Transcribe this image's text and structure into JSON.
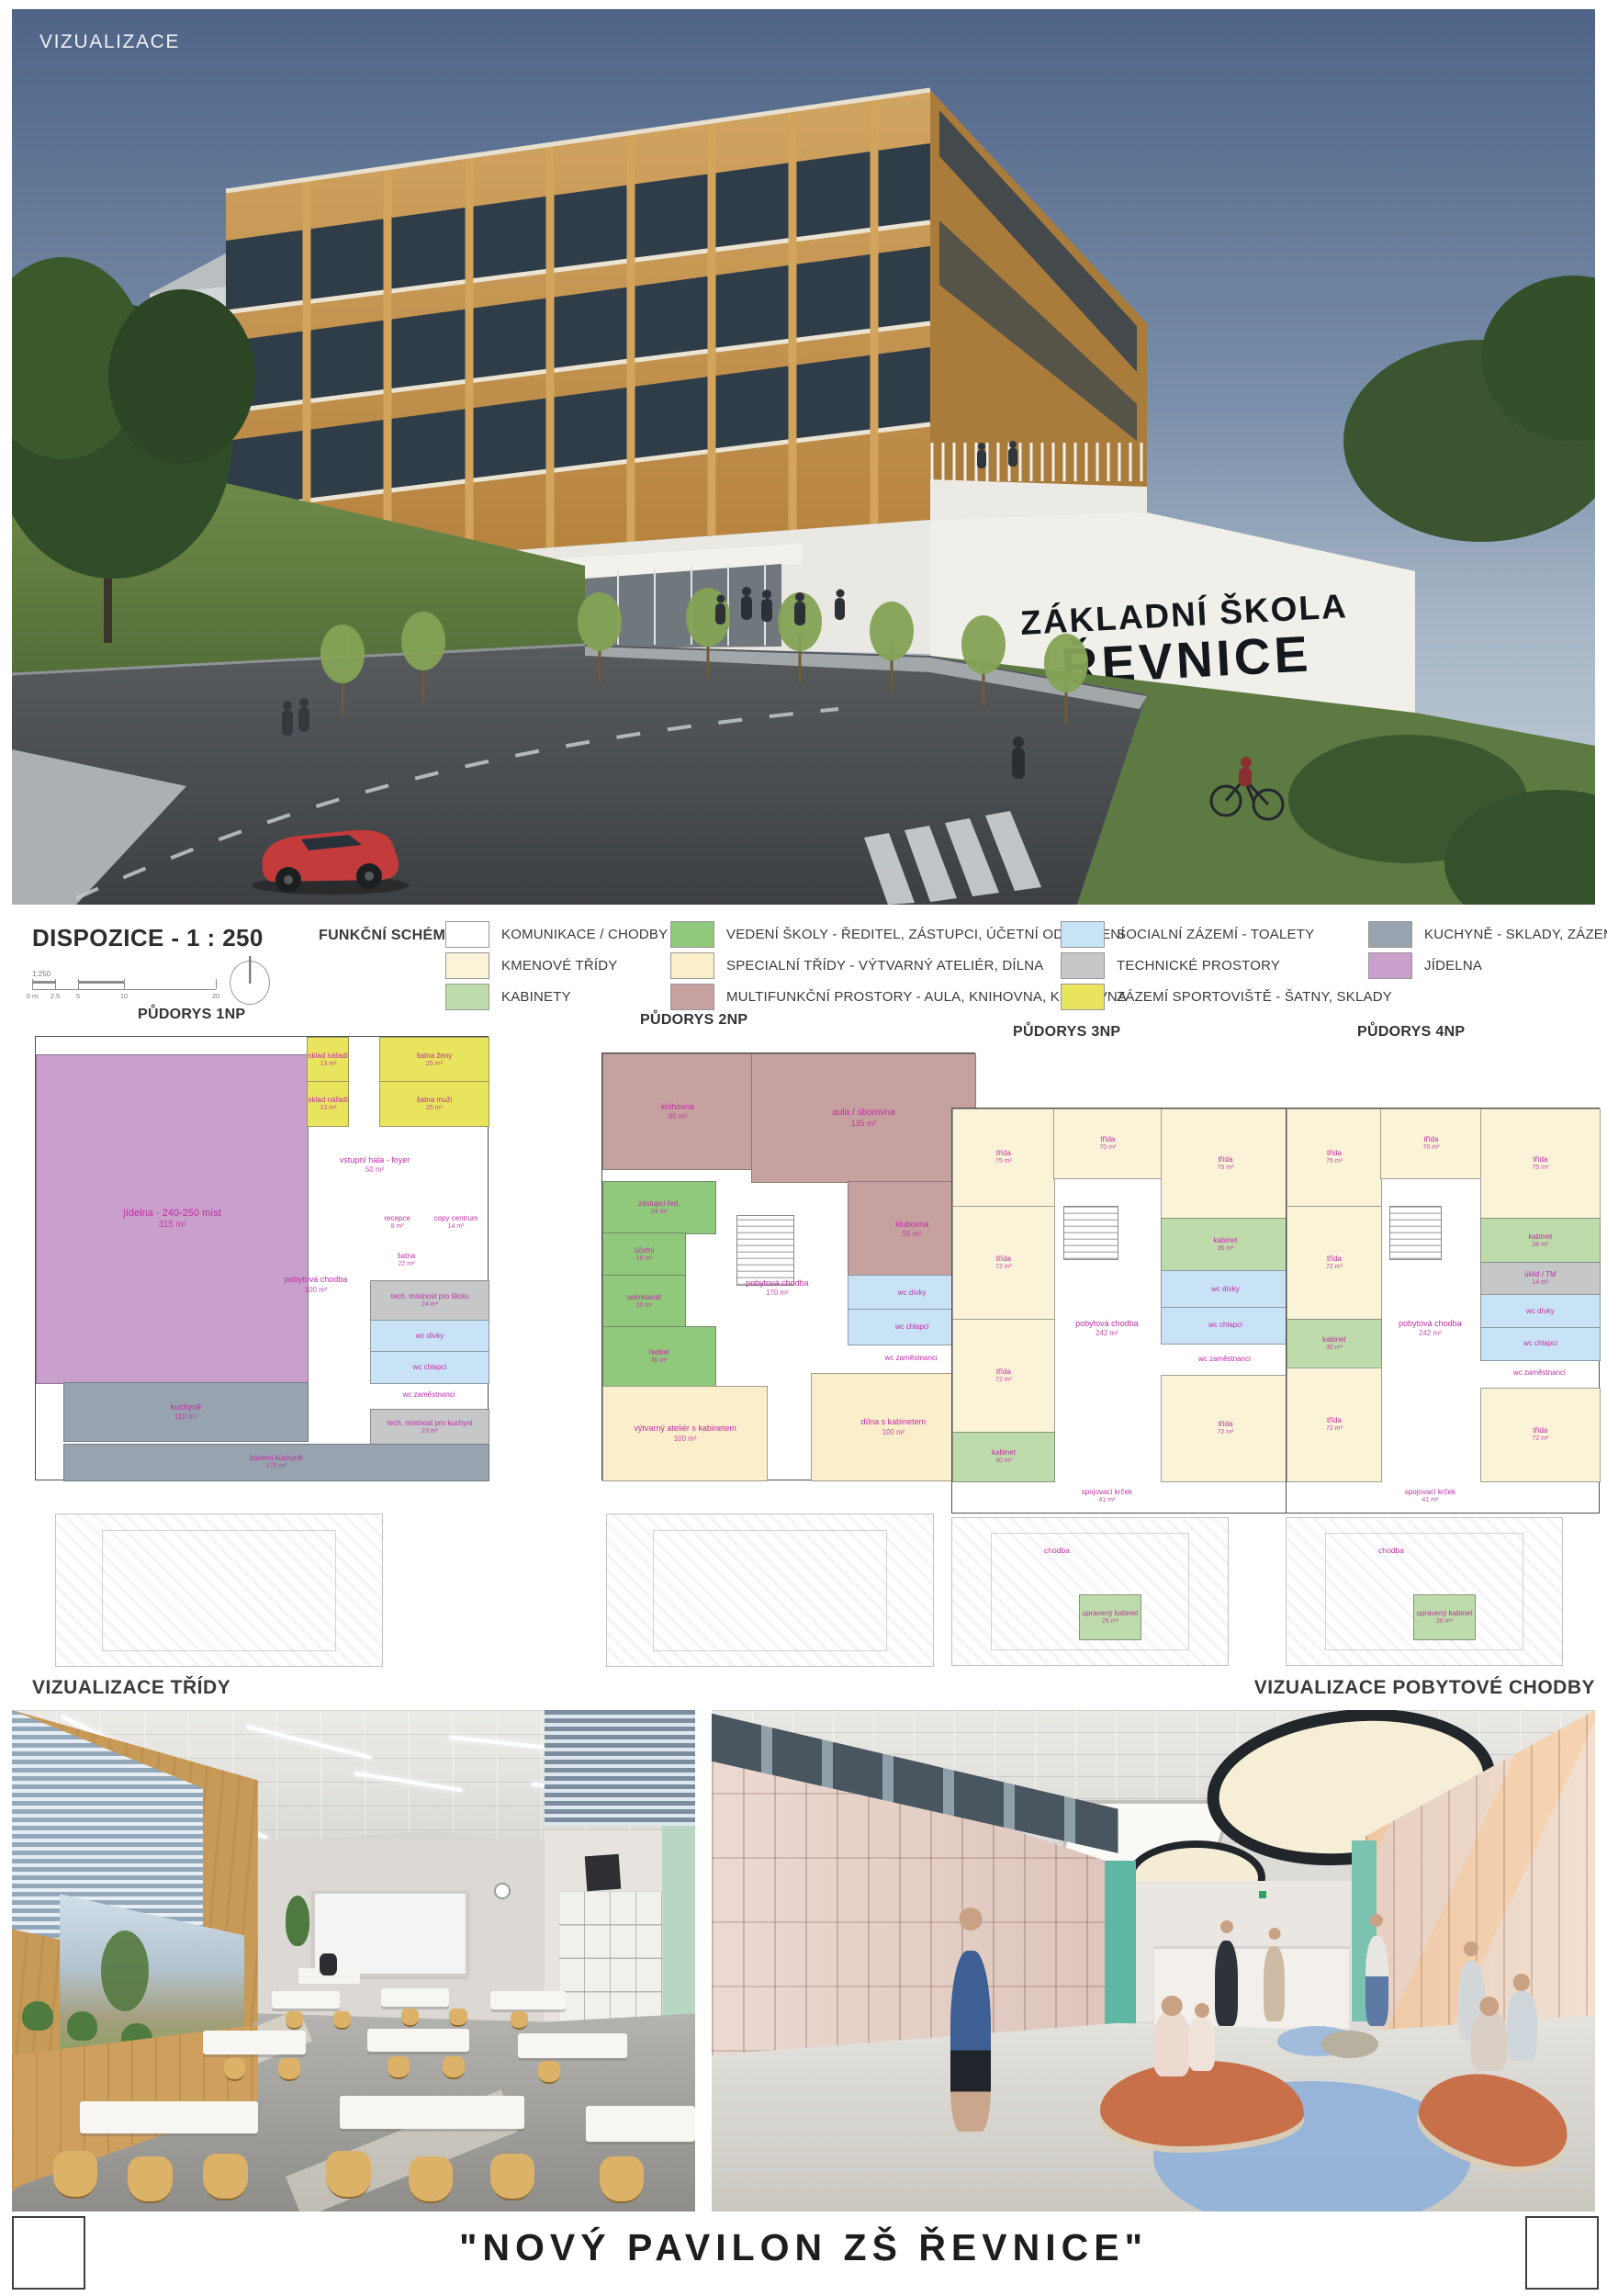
{
  "hero": {
    "label": "VIZUALIZACE",
    "sign_line1": "ZÁKLADNÍ ŠKOLA",
    "sign_line2": "ŘEVNICE"
  },
  "dispozice": {
    "title": "DISPOZICE - 1 : 250",
    "schema_label": "FUNKČNÍ SCHÉMA",
    "scale": {
      "ratio": "1:250",
      "ticks": [
        {
          "t": "0 m",
          "p": 0
        },
        {
          "t": "2.5",
          "p": 12.5
        },
        {
          "t": "5",
          "p": 25
        },
        {
          "t": "10",
          "p": 50
        },
        {
          "t": "20",
          "p": 100
        }
      ]
    },
    "legend_columns": [
      {
        "items": [
          {
            "color": "#ffffff",
            "label": "KOMUNIKACE / CHODBY"
          },
          {
            "color": "#faf3d8",
            "label": "KMENOVÉ TŘÍDY"
          },
          {
            "color": "#bedcab",
            "label": "KABINETY"
          }
        ]
      },
      {
        "items": [
          {
            "color": "#90c87c",
            "label": "VEDENÍ ŠKOLY - ŘEDITEL, ZÁSTUPCI, ÚČETNÍ ODDDĚLENÍ"
          },
          {
            "color": "#fbeecb",
            "label": "SPECIALNÍ TŘÍDY - VÝTVARNÝ ATELIÉR, DÍLNA"
          },
          {
            "color": "#c7a0a0",
            "label": "MULTIFUNKČNÍ PROSTORY - AULA, KNIHOVNA, KLUBOVNA"
          }
        ]
      },
      {
        "items": [
          {
            "color": "#c9e3f6",
            "label": "SOCIALNÍ ZÁZEMÍ - TOALETY"
          },
          {
            "color": "#c5c7c9",
            "label": "TECHNICKÉ PROSTORY"
          },
          {
            "color": "#e9e45e",
            "label": "ZÁZEMÍ SPORTOVIŠTĚ - ŠATNY, SKLADY"
          }
        ]
      },
      {
        "items": [
          {
            "color": "#97a3af",
            "label": "KUCHYNĚ - SKLADY, ZÁZEMÍ"
          },
          {
            "color": "#c99fcb",
            "label": "JÍDELNA"
          }
        ]
      }
    ]
  },
  "plans": [
    {
      "title": "PŮDORYS 1NP",
      "rooms": [
        {
          "x": 0,
          "y": 4,
          "w": 60,
          "h": 74,
          "c": "#c99fcb",
          "label": "jídelna - 240-250 míst",
          "area": "315 m²",
          "fs": 11
        },
        {
          "x": 60,
          "y": 0,
          "w": 9,
          "h": 10,
          "c": "#e9e45e",
          "label": "sklad nářadí",
          "area": "13 m²"
        },
        {
          "x": 60,
          "y": 10,
          "w": 9,
          "h": 10,
          "c": "#e9e45e",
          "label": "sklad nářadí",
          "area": "13 m²"
        },
        {
          "x": 76,
          "y": 0,
          "w": 24,
          "h": 10,
          "c": "#e9e45e",
          "label": "šatna ženy",
          "area": "25 m²"
        },
        {
          "x": 76,
          "y": 10,
          "w": 24,
          "h": 10,
          "c": "#e9e45e",
          "label": "šatna muži",
          "area": "25 m²"
        },
        {
          "x": 62,
          "y": 22,
          "w": 26,
          "h": 14,
          "c": "none",
          "label": "vstupní hala - foyer",
          "area": "50 m²",
          "fs": 9
        },
        {
          "x": 52,
          "y": 40,
          "w": 20,
          "h": 32,
          "c": "none",
          "label": "pobytová chodba",
          "area": "100 m²",
          "fs": 9
        },
        {
          "x": 74,
          "y": 38,
          "w": 12,
          "h": 8,
          "c": "none",
          "label": "recepce",
          "area": "8 m²"
        },
        {
          "x": 86,
          "y": 38,
          "w": 14,
          "h": 8,
          "c": "none",
          "label": "copy centrum",
          "area": "14 m²"
        },
        {
          "x": 74,
          "y": 46,
          "w": 16,
          "h": 9,
          "c": "none",
          "label": "šatna",
          "area": "22 m²"
        },
        {
          "x": 74,
          "y": 55,
          "w": 26,
          "h": 9,
          "c": "#c5c7c9",
          "label": "tech. místnost pro školu",
          "area": "24 m²"
        },
        {
          "x": 74,
          "y": 64,
          "w": 26,
          "h": 7,
          "c": "#c9e3f6",
          "label": "wc dívky",
          "area": ""
        },
        {
          "x": 74,
          "y": 71,
          "w": 26,
          "h": 7,
          "c": "#c9e3f6",
          "label": "wc chlapci",
          "area": ""
        },
        {
          "x": 74,
          "y": 78,
          "w": 26,
          "h": 6,
          "c": "none",
          "label": "wc zaměstnanci",
          "area": ""
        },
        {
          "x": 6,
          "y": 78,
          "w": 54,
          "h": 13,
          "c": "#97a3af",
          "label": "kuchyně",
          "area": "110 m²",
          "fs": 9
        },
        {
          "x": 74,
          "y": 84,
          "w": 26,
          "h": 8,
          "c": "#c5c7c9",
          "label": "tech. místnost pro kuchyni",
          "area": "23 m²"
        },
        {
          "x": 6,
          "y": 92,
          "w": 94,
          "h": 8,
          "c": "#97a3af",
          "label": "zázemí kuchyně",
          "area": "170 m²"
        }
      ],
      "annex_rooms": [],
      "annex_labels": []
    },
    {
      "title": "PŮDORYS 2NP",
      "rooms": [
        {
          "x": 0,
          "y": 0,
          "w": 40,
          "h": 27,
          "c": "#c7a0a0",
          "label": "knihovna",
          "area": "85 m²",
          "fs": 9
        },
        {
          "x": 40,
          "y": 0,
          "w": 60,
          "h": 30,
          "c": "#c7a0a0",
          "label": "aula / sborovna",
          "area": "135 m²",
          "fs": 10
        },
        {
          "x": 66,
          "y": 30,
          "w": 34,
          "h": 22,
          "c": "#c7a0a0",
          "label": "klubovna",
          "area": "55 m²",
          "fs": 9
        },
        {
          "x": 0,
          "y": 30,
          "w": 30,
          "h": 12,
          "c": "#90c87c",
          "label": "zástupci řed.",
          "area": "24 m²"
        },
        {
          "x": 0,
          "y": 42,
          "w": 22,
          "h": 10,
          "c": "#90c87c",
          "label": "účetní",
          "area": "16 m²"
        },
        {
          "x": 0,
          "y": 52,
          "w": 22,
          "h": 12,
          "c": "#90c87c",
          "label": "sekretariát",
          "area": "20 m²"
        },
        {
          "x": 0,
          "y": 64,
          "w": 30,
          "h": 14,
          "c": "#90c87c",
          "label": "ředitel",
          "area": "30 m²"
        },
        {
          "x": 32,
          "y": 36,
          "w": 30,
          "h": 38,
          "c": "none",
          "label": "pobytová chodba",
          "area": "170 m²",
          "fs": 9
        },
        {
          "x": 66,
          "y": 52,
          "w": 34,
          "h": 8,
          "c": "#c9e3f6",
          "label": "wc dívky",
          "area": ""
        },
        {
          "x": 66,
          "y": 60,
          "w": 34,
          "h": 8,
          "c": "#c9e3f6",
          "label": "wc chlapci",
          "area": ""
        },
        {
          "x": 66,
          "y": 68,
          "w": 34,
          "h": 7,
          "c": "none",
          "label": "wc zaměstnanci",
          "area": ""
        },
        {
          "x": 0,
          "y": 78,
          "w": 44,
          "h": 22,
          "c": "#fbeecb",
          "label": "výtvarný ateliér s kabinetem",
          "area": "100 m²",
          "fs": 9
        },
        {
          "x": 56,
          "y": 75,
          "w": 44,
          "h": 25,
          "c": "#fbeecb",
          "label": "dílna s kabinetem",
          "area": "100 m²",
          "fs": 9
        }
      ],
      "annex_rooms": [],
      "annex_labels": []
    },
    {
      "title": "PŮDORYS 3NP",
      "rooms": [
        {
          "x": 0,
          "y": 0,
          "w": 30,
          "h": 24,
          "c": "#faf3d8",
          "label": "třída",
          "area": "75 m²"
        },
        {
          "x": 30,
          "y": 0,
          "w": 32,
          "h": 17,
          "c": "#faf3d8",
          "label": "třída",
          "area": "70 m²"
        },
        {
          "x": 62,
          "y": 0,
          "w": 38,
          "h": 27,
          "c": "#faf3d8",
          "label": "třída",
          "area": "75 m²"
        },
        {
          "x": 0,
          "y": 24,
          "w": 30,
          "h": 28,
          "c": "#faf3d8",
          "label": "třída",
          "area": "72 m²"
        },
        {
          "x": 0,
          "y": 52,
          "w": 30,
          "h": 28,
          "c": "#faf3d8",
          "label": "třída",
          "area": "72 m²"
        },
        {
          "x": 0,
          "y": 80,
          "w": 30,
          "h": 12,
          "c": "#bedcab",
          "label": "kabinet",
          "area": "30 m²"
        },
        {
          "x": 62,
          "y": 27,
          "w": 38,
          "h": 13,
          "c": "#bedcab",
          "label": "kabinet",
          "area": "36 m²"
        },
        {
          "x": 62,
          "y": 40,
          "w": 38,
          "h": 9,
          "c": "#c9e3f6",
          "label": "wc dívky",
          "area": ""
        },
        {
          "x": 62,
          "y": 49,
          "w": 38,
          "h": 9,
          "c": "#c9e3f6",
          "label": "wc chlapci",
          "area": ""
        },
        {
          "x": 62,
          "y": 58,
          "w": 38,
          "h": 8,
          "c": "none",
          "label": "wc zaměstnanci",
          "area": ""
        },
        {
          "x": 62,
          "y": 66,
          "w": 38,
          "h": 26,
          "c": "#faf3d8",
          "label": "třída",
          "area": "72 m²"
        },
        {
          "x": 30,
          "y": 17,
          "w": 32,
          "h": 75,
          "c": "none",
          "label": "pobytová chodba",
          "area": "242 m²",
          "fs": 9
        },
        {
          "x": 30,
          "y": 92,
          "w": 32,
          "h": 8,
          "c": "none",
          "label": "spojovací krček",
          "area": "41 m²"
        }
      ],
      "annex_rooms": [
        {
          "x": 46,
          "y": 52,
          "w": 22,
          "h": 30,
          "c": "#bedcab",
          "label": "upravený kabinet",
          "area": "26 m²"
        }
      ],
      "annex_labels": [
        {
          "x": 38,
          "y": 22,
          "label": "chodba"
        }
      ]
    },
    {
      "title": "PŮDORYS 4NP",
      "rooms": [
        {
          "x": 0,
          "y": 0,
          "w": 30,
          "h": 24,
          "c": "#faf3d8",
          "label": "třída",
          "area": "75 m²"
        },
        {
          "x": 30,
          "y": 0,
          "w": 32,
          "h": 17,
          "c": "#faf3d8",
          "label": "třída",
          "area": "70 m²"
        },
        {
          "x": 62,
          "y": 0,
          "w": 38,
          "h": 27,
          "c": "#faf3d8",
          "label": "třída",
          "area": "75 m²"
        },
        {
          "x": 0,
          "y": 24,
          "w": 30,
          "h": 28,
          "c": "#faf3d8",
          "label": "třída",
          "area": "72 m²"
        },
        {
          "x": 0,
          "y": 52,
          "w": 30,
          "h": 12,
          "c": "#bedcab",
          "label": "kabinet",
          "area": "30 m²"
        },
        {
          "x": 0,
          "y": 64,
          "w": 30,
          "h": 28,
          "c": "#faf3d8",
          "label": "třída",
          "area": "72 m²"
        },
        {
          "x": 62,
          "y": 27,
          "w": 38,
          "h": 11,
          "c": "#bedcab",
          "label": "kabinet",
          "area": "28 m²"
        },
        {
          "x": 62,
          "y": 38,
          "w": 38,
          "h": 8,
          "c": "#c5c7c9",
          "label": "úklid / TM",
          "area": "14 m²"
        },
        {
          "x": 62,
          "y": 46,
          "w": 38,
          "h": 8,
          "c": "#c9e3f6",
          "label": "wc dívky",
          "area": ""
        },
        {
          "x": 62,
          "y": 54,
          "w": 38,
          "h": 8,
          "c": "#c9e3f6",
          "label": "wc chlapci",
          "area": ""
        },
        {
          "x": 62,
          "y": 62,
          "w": 38,
          "h": 7,
          "c": "none",
          "label": "wc zaměstnanci",
          "area": ""
        },
        {
          "x": 62,
          "y": 69,
          "w": 38,
          "h": 23,
          "c": "#faf3d8",
          "label": "třída",
          "area": "72 m²"
        },
        {
          "x": 30,
          "y": 17,
          "w": 32,
          "h": 75,
          "c": "none",
          "label": "pobytová chodba",
          "area": "242 m²",
          "fs": 9
        },
        {
          "x": 30,
          "y": 92,
          "w": 32,
          "h": 8,
          "c": "none",
          "label": "spojovací krček",
          "area": "41 m²"
        }
      ],
      "annex_rooms": [
        {
          "x": 46,
          "y": 52,
          "w": 22,
          "h": 30,
          "c": "#bedcab",
          "label": "upravený kabinet",
          "area": "26 m²"
        }
      ],
      "annex_labels": [
        {
          "x": 38,
          "y": 22,
          "label": "chodba"
        }
      ]
    }
  ],
  "interiors": {
    "left_label": "VIZUALIZACE TŘÍDY",
    "right_label": "VIZUALIZACE POBYTOVÉ CHODBY"
  },
  "footer": {
    "title": "\"NOVÝ PAVILON ZŠ ŘEVNICE\""
  },
  "palette": {
    "label_magenta": "#c12da4",
    "wood_facade": "#c59450",
    "sky_top": "#4f6487",
    "accent_mint": "#b7d6c3",
    "accent_teal": "#5fb6a3",
    "bench_orange": "#c8704a",
    "rug_blue": "#91b2d9"
  }
}
